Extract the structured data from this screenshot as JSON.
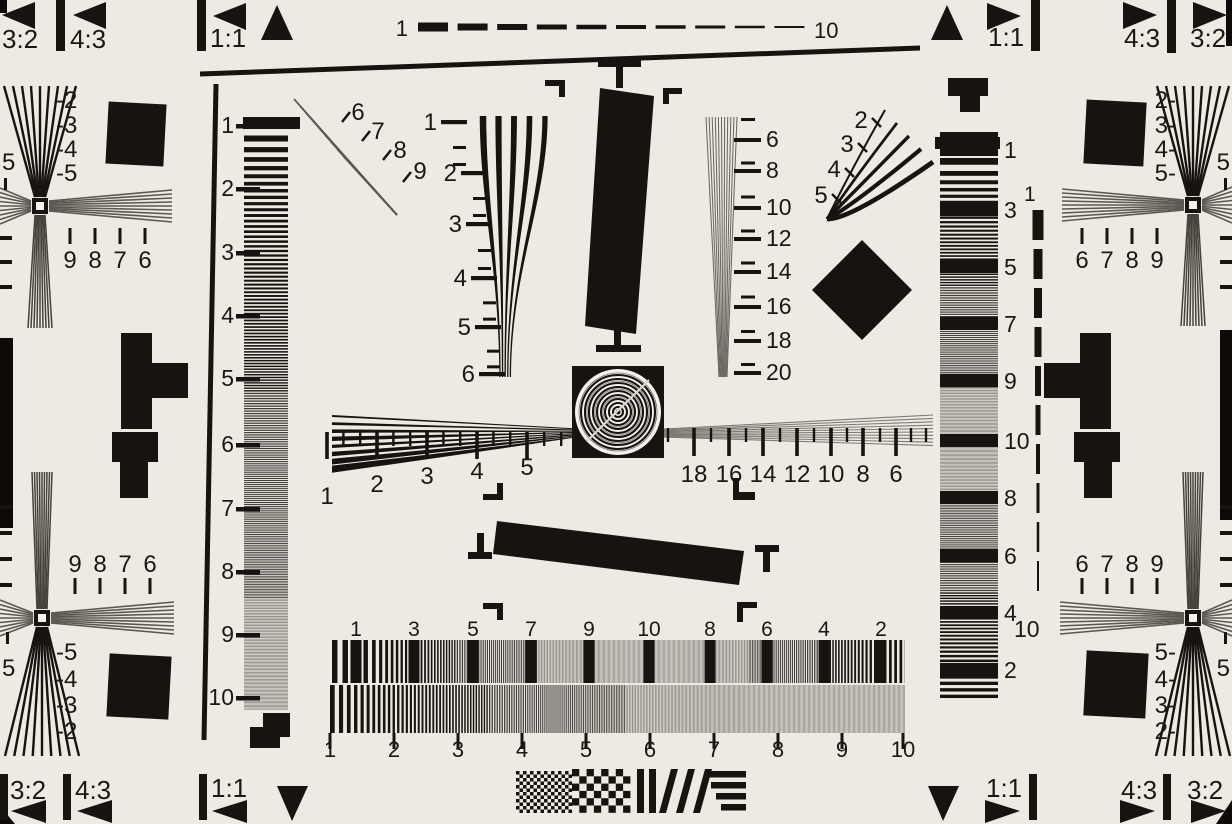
{
  "colors": {
    "background": "#ECEAE2",
    "ink": "#171410",
    "soft_black": "#45423C",
    "gray_line": "#5A5850",
    "gray_fill": "#8E8C84",
    "white": "#F2F1EA",
    "photo_edge": "#0C0B0A"
  },
  "corner_markers": {
    "top_left": [
      "3:2",
      "4:3",
      "1:1"
    ],
    "top_right": [
      "1:1",
      "4:3",
      "3:2"
    ],
    "bottom_left": [
      "3:2",
      "4:3",
      "1:1"
    ],
    "bottom_right": [
      "1:1",
      "4:3",
      "3:2"
    ]
  },
  "top_dash_scale": {
    "start": "1",
    "end": "10"
  },
  "right_dash_scale": {
    "start": "1",
    "end": "10"
  },
  "left_column": {
    "labels": [
      "1",
      "2",
      "3",
      "4",
      "5",
      "6",
      "7",
      "8",
      "9",
      "10"
    ]
  },
  "right_column": {
    "labels": [
      "1",
      "3",
      "5",
      "7",
      "9",
      "10",
      "8",
      "6",
      "4",
      "2"
    ]
  },
  "center_wedge_left_scale": [
    "1",
    "2",
    "3",
    "4",
    "5",
    "6"
  ],
  "center_wedge_right_scale": [
    "6",
    "8",
    "10",
    "12",
    "14",
    "16",
    "18",
    "20"
  ],
  "diag_wedge_left_labels": [
    "6",
    "7",
    "8",
    "9"
  ],
  "diag_wedge_right_labels": [
    "2",
    "3",
    "4",
    "5"
  ],
  "ruler_left_labels": [
    "1",
    "2",
    "3",
    "4",
    "5"
  ],
  "ruler_right_labels": [
    "18",
    "16",
    "14",
    "12",
    "10",
    "8",
    "6"
  ],
  "bottom_row_a_labels": [
    "1",
    "3",
    "5",
    "7",
    "9",
    "10",
    "8",
    "6",
    "4",
    "2"
  ],
  "bottom_row_b_labels": [
    "1",
    "2",
    "3",
    "4",
    "5",
    "6",
    "7",
    "8",
    "9",
    "10"
  ],
  "clusters": {
    "top_left": {
      "vertical": [
        "-2",
        "-3",
        "-4",
        "-5"
      ],
      "horizontal": [
        "9",
        "8",
        "7",
        "6"
      ],
      "edge": "5"
    },
    "bottom_left": {
      "vertical": [
        "-5",
        "-4",
        "-3",
        "-2"
      ],
      "horizontal": [
        "9",
        "8",
        "7",
        "6"
      ],
      "edge": "5"
    },
    "top_right": {
      "vertical": [
        "2-",
        "3-",
        "4-",
        "5-"
      ],
      "horizontal": [
        "6",
        "7",
        "8",
        "9"
      ],
      "edge": "5"
    },
    "bottom_right": {
      "vertical": [
        "5-",
        "4-",
        "3-",
        "2-"
      ],
      "horizontal": [
        "6",
        "7",
        "8",
        "9"
      ],
      "edge": "5"
    }
  }
}
